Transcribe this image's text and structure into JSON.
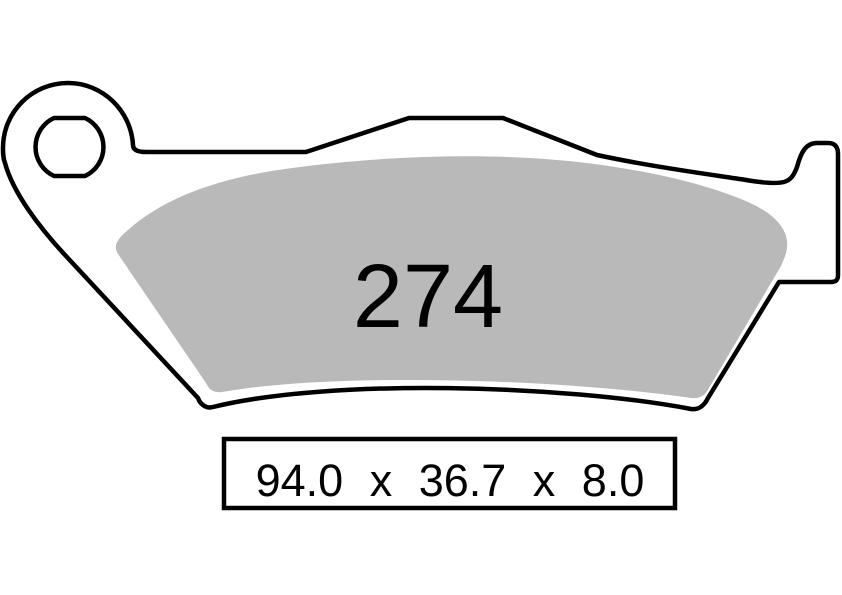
{
  "drawing": {
    "part_number": "274",
    "dimensions": {
      "display": "94.0 x 36.7 x 8.0",
      "width": "94.0",
      "height": "36.7",
      "thickness": "8.0",
      "separator": "x"
    }
  },
  "colors": {
    "background": "#ffffff",
    "line": "#000000",
    "friction_material": "#b9b9b9",
    "text": "#000000"
  }
}
